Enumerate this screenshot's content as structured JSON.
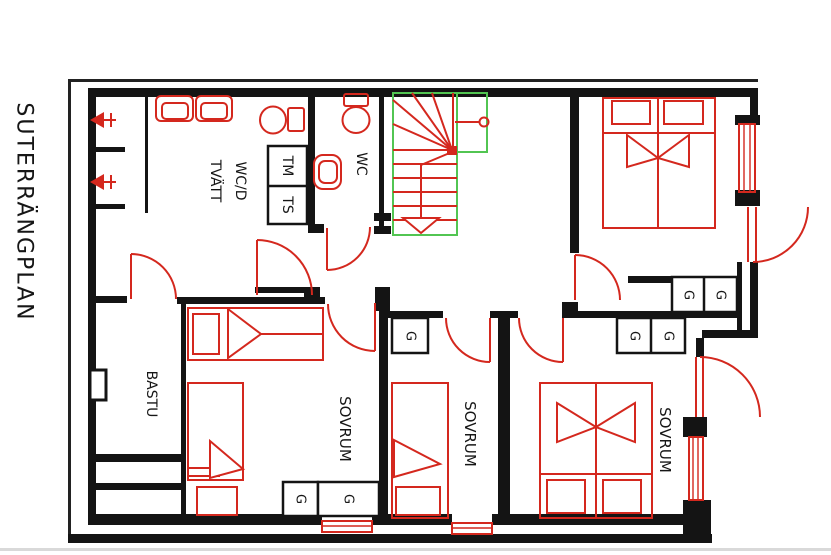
{
  "plan": {
    "title": "SUTERRÄNGPLAN",
    "labels": {
      "laundry_line1": "WC/D",
      "laundry_line2": "TVÄTT",
      "washing_machine": "TM",
      "dryer": "TS",
      "wc": "WC",
      "sauna": "BASTU",
      "bedroom": "SOVRUM",
      "closet": "G"
    },
    "colors": {
      "wall_black": "#141414",
      "fixture_red": "#d4281e",
      "stair_green": "#52c552",
      "sheet_edge_gray": "#d9d9d9"
    }
  }
}
